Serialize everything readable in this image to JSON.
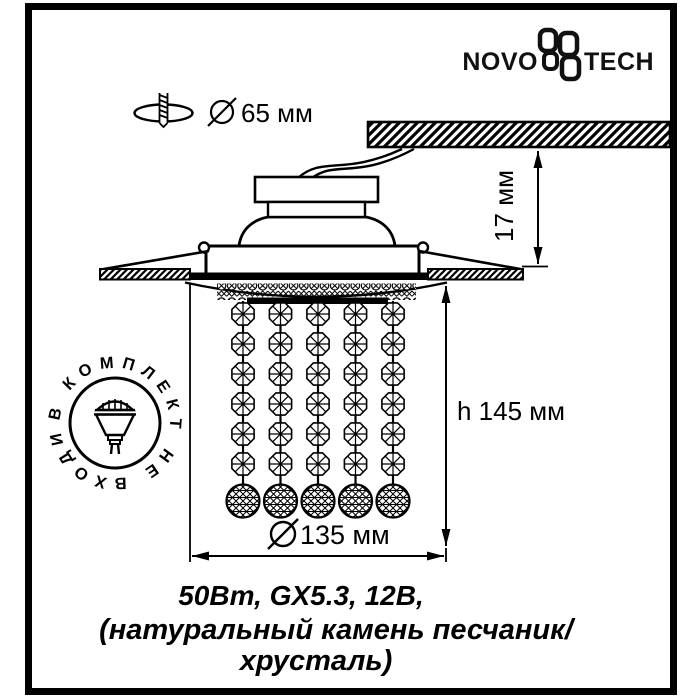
{
  "brand": {
    "wordmark_left": "NOVO",
    "wordmark_right": "TECH"
  },
  "dimensions": {
    "hole_diameter": "65 мм",
    "recess_depth": "17 мм",
    "height": "h 145 мм",
    "outer_diameter": "135 мм"
  },
  "stamp": {
    "text": "В КОМПЛЕКТ НЕ ВХОДИТ"
  },
  "specs": {
    "line1": "50Вт, GX5.3, 12В,",
    "line2": "(натуральный камень песчаник/",
    "line3": "хрусталь)"
  },
  "colors": {
    "ink": "#000000",
    "paper": "#ffffff"
  }
}
